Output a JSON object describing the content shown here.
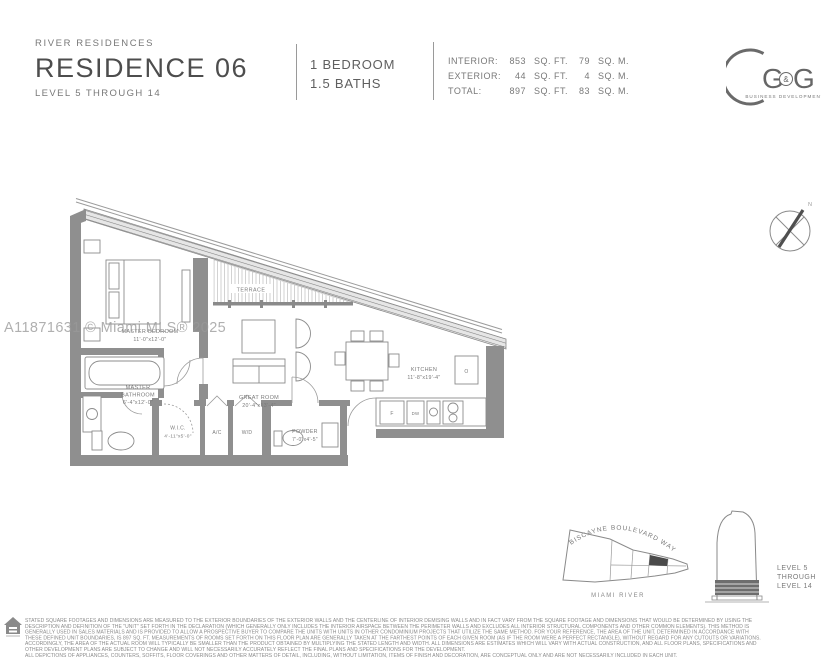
{
  "page": {
    "title": "Residence 06 Floor Plan Sheet"
  },
  "header": {
    "project": "RIVER RESIDENCES",
    "residence": "RESIDENCE 06",
    "levels": "LEVEL 5 THROUGH 14",
    "bedrooms": "1 BEDROOM",
    "baths": "1.5 BATHS",
    "area_rows": [
      {
        "label": "INTERIOR:",
        "sqft": "853",
        "sqft_unit": "SQ. FT.",
        "sqm": "79",
        "sqm_unit": "SQ. M."
      },
      {
        "label": "EXTERIOR:",
        "sqft": "44",
        "sqft_unit": "SQ. FT.",
        "sqm": "4",
        "sqm_unit": "SQ. M."
      },
      {
        "label": "TOTAL:",
        "sqft": "897",
        "sqft_unit": "SQ. FT.",
        "sqm": "83",
        "sqm_unit": "SQ. M."
      }
    ],
    "logo": {
      "g1": "G",
      "amp": "&",
      "g2": "G",
      "subtext": "BUSINESS DEVELOPMENTS"
    }
  },
  "watermark": "A11871631 © Miami MLS® 2025",
  "compass": {
    "north": "N"
  },
  "floorplan": {
    "terrace": "TERRACE",
    "master_bedroom_name": "MASTER BEDROOM",
    "master_bedroom_dims": "11'-0\"x12'-0\"",
    "master_bath_line1": "MASTER",
    "master_bath_line2": "BATHROOM",
    "master_bath_dims": "6'-4\"x12'-0\"",
    "wic_name": "W.I.C.",
    "wic_dims": "4'-11\"x5'-0\"",
    "ac": "A/C",
    "wd": "W/D",
    "great_room_name": "GREAT ROOM",
    "great_room_dims": "20'-4\"x13'-4\"",
    "kitchen_name": "KITCHEN",
    "kitchen_dims": "11'-8\"x19'-4\"",
    "powder_name": "POWDER",
    "powder_dims": "7'-0\"x4'-5\"",
    "fridge": "F",
    "dishwasher": "DW",
    "oven": "O"
  },
  "keyplan": {
    "street": "BISCAYNE BOULEVARD WAY",
    "river": "MIAMI RIVER",
    "levels_line1": "LEVEL 5",
    "levels_line2": "THROUGH",
    "levels_line3": "LEVEL 14"
  },
  "disclaimer": {
    "lines": [
      "STATED SQUARE FOOTAGES AND DIMENSIONS ARE MEASURED TO THE EXTERIOR BOUNDARIES OF THE EXTERIOR WALLS AND THE CENTERLINE OF INTERIOR DEMISING WALLS AND IN FACT VARY FROM THE SQUARE FOOTAGE AND DIMENSIONS THAT WOULD BE DETERMINED BY USING THE",
      "DESCRIPTION AND DEFINITION OF THE \"UNIT\" SET FORTH IN THE DECLARATION (WHICH GENERALLY ONLY INCLUDES THE INTERIOR AIRSPACE BETWEEN THE PERIMETER WALLS AND EXCLUDES ALL INTERIOR STRUCTURAL COMPONENTS AND OTHER COMMON ELEMENTS). THIS METHOD IS",
      "GENERALLY USED IN SALES MATERIALS AND IS PROVIDED TO ALLOW A PROSPECTIVE BUYER TO COMPARE THE UNITS WITH UNITS IN OTHER CONDOMINIUM PROJECTS THAT UTILIZE THE SAME METHOD. FOR YOUR REFERENCE, THE AREA OF THE UNIT, DETERMINED IN ACCORDANCE WITH",
      "THESE DEFINED UNIT BOUNDARIES, IS 897 SQ. FT. MEASUREMENTS OF ROOMS SET FORTH ON THIS FLOOR PLAN ARE GENERALLY TAKEN AT THE FARTHEST POINTS OF EACH GIVEN ROOM (AS IF THE ROOM WERE A PERFECT RECTANGLE), WITHOUT REGARD FOR ANY CUTOUTS OR VARIATIONS.",
      "ACCORDINGLY, THE AREA OF THE ACTUAL ROOM WILL TYPICALLY BE SMALLER THAN THE PRODUCT OBTAINED BY MULTIPLYING THE STATED LENGTH AND WIDTH. ALL DIMENSIONS ARE ESTIMATES WHICH WILL VARY WITH ACTUAL CONSTRUCTION, AND ALL FLOOR PLANS, SPECIFICATIONS AND",
      "OTHER DEVELOPMENT PLANS ARE SUBJECT TO CHANGE AND WILL NOT NECESSARILY ACCURATELY REFLECT THE FINAL PLANS AND SPECIFICATIONS FOR THE DEVELOPMENT.",
      "ALL DEPICTIONS OF APPLIANCES, COUNTERS, SOFFITS, FLOOR COVERINGS AND OTHER MATTERS OF DETAIL, INCLUDING, WITHOUT LIMITATION, ITEMS OF FINISH AND DECORATION, ARE CONCEPTUAL ONLY AND ARE NOT NECESSARILY INCLUDED IN EACH UNIT."
    ]
  },
  "colors": {
    "wall_gray": "#8f8f8f",
    "label_gray": "#7a7a7a",
    "title_gray": "#4d4d4d",
    "keyplan_highlight": "#4a4a4a"
  }
}
